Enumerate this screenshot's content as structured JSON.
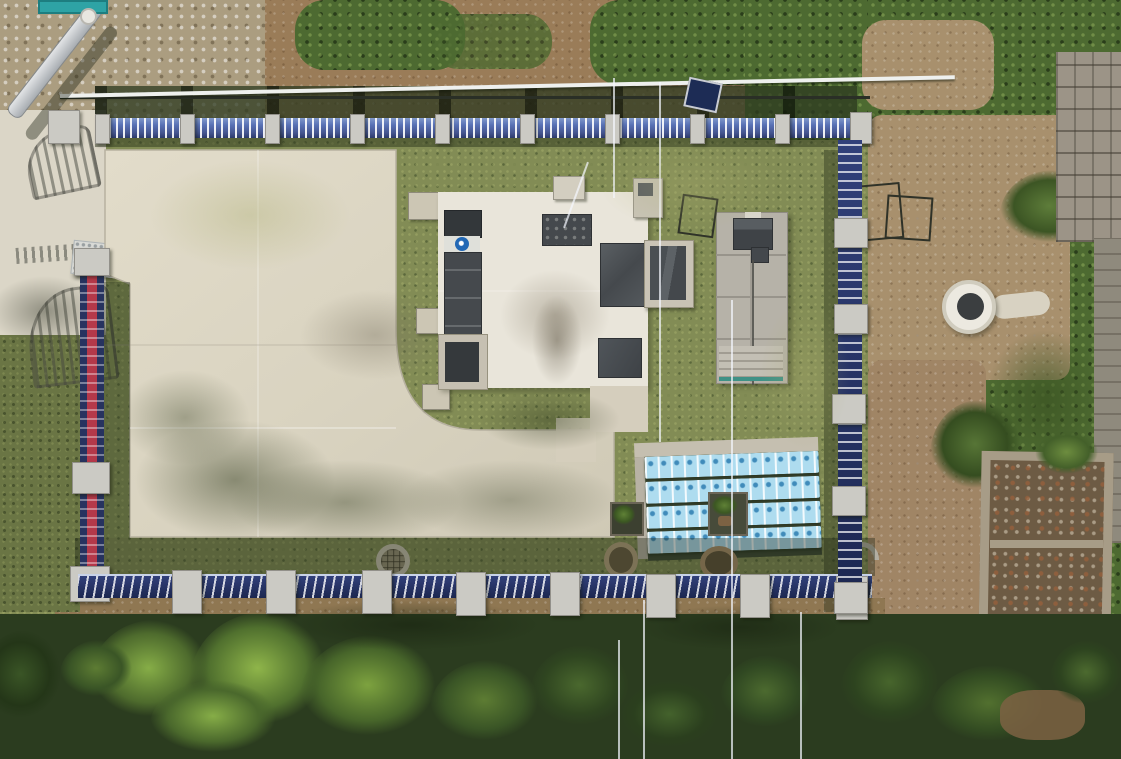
{
  "scene": {
    "type": "aerial-drone-photograph",
    "description": "Top-down drone view of a small fenced water-treatment / utility compound with concrete pads, a flat-roofed plant building, equipment wrapped in blue protective film, blue security fencing with concrete posts, surrounded by grass, bare earth, a ruined stone hut and dense trees",
    "no_visible_text": true
  },
  "palette": {
    "grass_base": "#828c55",
    "grass_light_patch": "#a3a86d",
    "grass_dark_shadow": "#4a5733",
    "dirt": "#9a7c58",
    "dirt_right": "#a8906d",
    "rocky_ground": "#ab9d80",
    "concrete_pad": "#d9d3c0",
    "building_roof": "#e9e5da",
    "plaza_concrete": "#dbd6c7",
    "dark_equipment": "#45494d",
    "gray_building": "#b6b2a8",
    "blue_wrap_film": "#aedcef",
    "blue_wrap_logo": "#3482b4",
    "fence_navy": "#1c2750",
    "fence_blue_rail": "#5871b5",
    "fence_red_stripe": "#b5394a",
    "concrete_post": "#cbcac4",
    "tree_dark": "#2b3c1f",
    "tree_bright": "#86ad47",
    "well_ring_white": "#ece9e0",
    "logo_blue_circle": "#2268b5",
    "teal_equipment_edge": "#3f9186"
  },
  "counts": {
    "top_fence_posts": 10,
    "bottom_fence_posts": 9,
    "right_fence_posts": 6,
    "left_fence_posts": 3,
    "blue_wrapped_rows": 4,
    "manhole_covers": 3,
    "planter_boxes": 2,
    "dark_roof_openings": 5,
    "small_square_pads": 5
  },
  "objects": [
    "entrance-plaza-with-gate-shadows",
    "metal-chute",
    "white-handrail-pipe",
    "main-plant-building-roof",
    "aeration-channel",
    "blue-company-logo",
    "gray-equipment-building",
    "blue-film-wrapped-panel-array",
    "white-well-head",
    "ruined-stone-hut",
    "stone-retaining-wall",
    "perimeter-security-fence",
    "manhole-covers",
    "planter-boxes",
    "tree-canopy",
    "utility-wires"
  ]
}
